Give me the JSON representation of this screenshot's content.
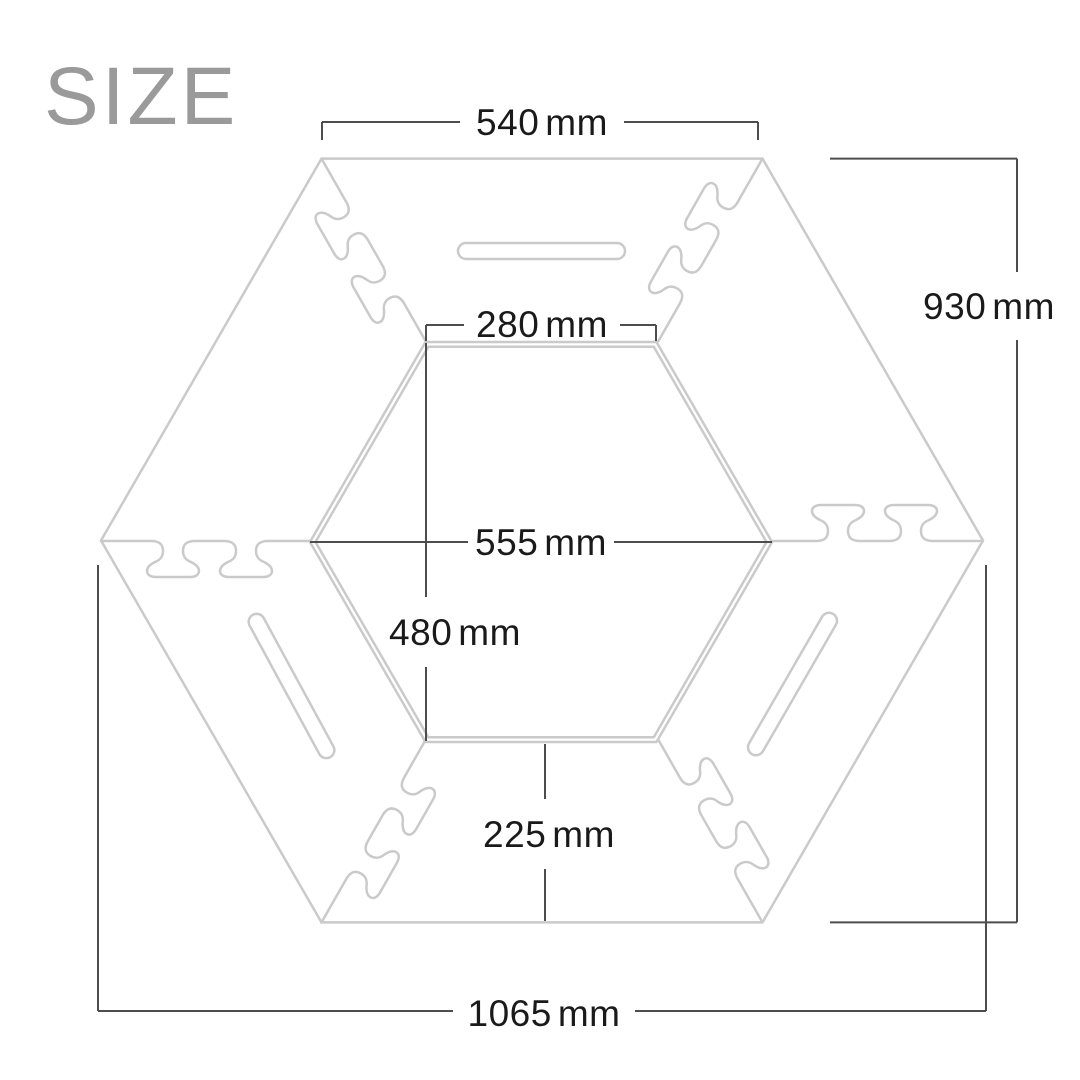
{
  "page": {
    "background": "#ffffff"
  },
  "title": {
    "text": "SIZE",
    "color": "#9a9a9a"
  },
  "diagram": {
    "type": "hexagonal-table-size-diagram",
    "colors": {
      "outline": "#cacaca",
      "dimension_line": "#4d4d4d",
      "label_text": "#1a1a1a"
    },
    "dimensions": {
      "top_edge": {
        "value": "540",
        "unit": "mm"
      },
      "overall_height": {
        "value": "930",
        "unit": "mm"
      },
      "inner_top_edge": {
        "value": "280",
        "unit": "mm"
      },
      "inner_width": {
        "value": "555",
        "unit": "mm"
      },
      "inner_height": {
        "value": "480",
        "unit": "mm"
      },
      "ring_depth": {
        "value": "225",
        "unit": "mm"
      },
      "overall_width": {
        "value": "1065",
        "unit": "mm"
      }
    }
  }
}
